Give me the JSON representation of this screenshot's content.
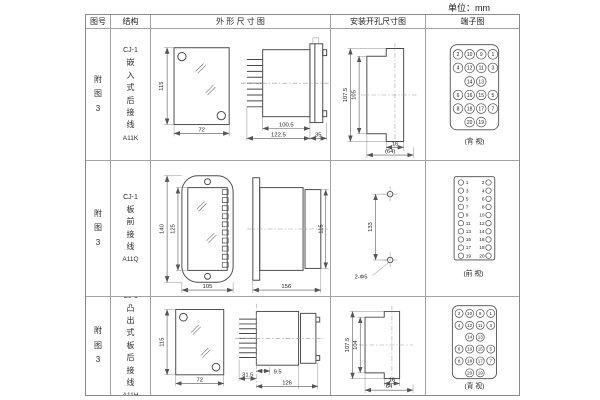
{
  "unit_label": "单位：mm",
  "header": {
    "fig": "图号",
    "structure": "结构",
    "outline": "外 形 尺 寸 图",
    "mounting": "安装开孔尺寸图",
    "terminal": "端子图"
  },
  "rows": [
    {
      "fig_no": "附图3",
      "model": "CJ-1",
      "desc": "嵌入式后接线",
      "code": "A11K",
      "outline": {
        "height": "115",
        "width": "72",
        "body_depth": "100.5",
        "total_depth": "122.5",
        "flange": "35"
      },
      "mounting": {
        "outer_h": "107.5",
        "inner_h": "105",
        "inner_w": "16",
        "outer_w": "(64)"
      },
      "terminal_caption": "(背 视)"
    },
    {
      "fig_no": "附图3",
      "model": "CJ-1",
      "desc": "板前接线",
      "code": "A11Q",
      "outline": {
        "outer_h": "140",
        "inner_h": "125",
        "width": "105",
        "length": "156",
        "side_h": "115"
      },
      "mounting": {
        "spacing": "133",
        "holes": "2-Φ5"
      },
      "terminal_caption": "(前 视)"
    },
    {
      "fig_no": "附图3",
      "model": "CJ-1",
      "desc": "凸出式板后接线",
      "code": "A11H",
      "outline": {
        "height": "115",
        "width": "72",
        "pin_depth": "31.5",
        "offset": "9.5",
        "length": "126"
      },
      "mounting": {
        "outer_h": "107.5",
        "inner_h": "104",
        "inner_w": "16",
        "outer_w": "64"
      },
      "terminal_caption": "(背 视)"
    }
  ],
  "terminal_rear": {
    "grid": [
      [
        "2",
        "10",
        "9",
        "1"
      ],
      [
        "4",
        "12",
        "11",
        "3"
      ],
      [
        null,
        "14",
        "13",
        null
      ],
      [
        "6",
        "16",
        "15",
        "5"
      ],
      [
        "8",
        "18",
        "17",
        "7"
      ],
      [
        null,
        "20",
        "19",
        null
      ]
    ]
  },
  "terminal_front": {
    "left": [
      "1",
      "3",
      "5",
      "7",
      "9",
      "11",
      "13",
      "15",
      "17",
      "19"
    ],
    "right": [
      "2",
      "4",
      "6",
      "8",
      "10",
      "12",
      "14",
      "16",
      "18",
      "20"
    ]
  }
}
